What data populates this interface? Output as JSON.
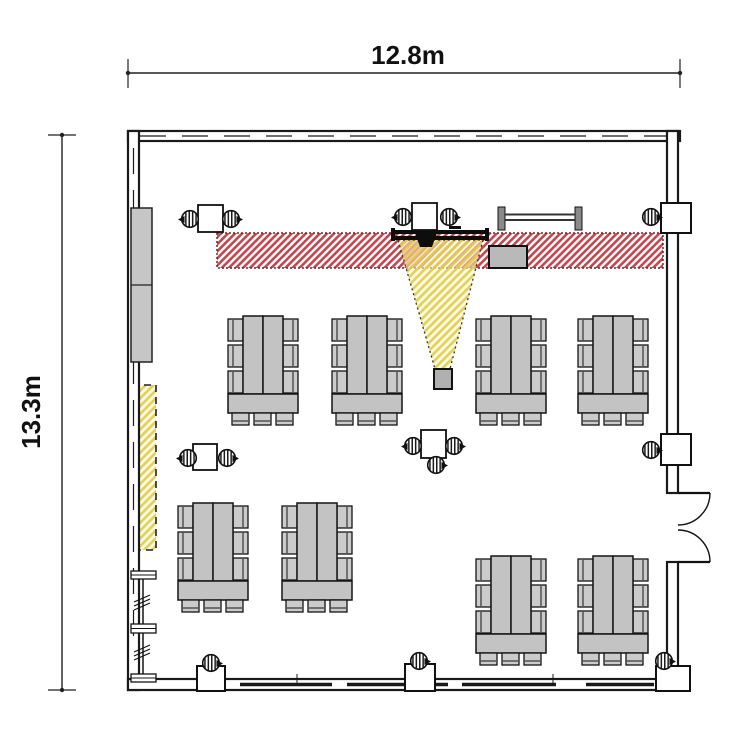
{
  "plan": {
    "type": "classroom floor plan",
    "dimensions": {
      "width": {
        "label": "12.8m"
      },
      "height": {
        "label": "13.3m"
      }
    },
    "colors": {
      "background": "#ffffff",
      "wall_line": "#1a1a1a",
      "furniture_gray": "#c3c3c3",
      "red_hatch_stripe": "#c5454f",
      "red_hatch_border": "#7c2028",
      "yellow_hatch_stripe": "#e2cb46",
      "yellow_hatch_bg": "#fcf7cd",
      "screen_black": "#0d0d0d",
      "projector_box_gray": "#b0b0b0"
    },
    "inventory": {
      "table_groups": 8,
      "chairs_per_group": 9,
      "small_desks": 4,
      "stool_symbols": 14,
      "wall_columns": 5,
      "double_doors": 1,
      "hatched_zones": {
        "red": 1,
        "yellow": 2
      },
      "storage_cabinets": 1,
      "shelf_racks": 1,
      "folding_tables": 1,
      "equipment_boxes": 1,
      "screens": 1
    }
  }
}
